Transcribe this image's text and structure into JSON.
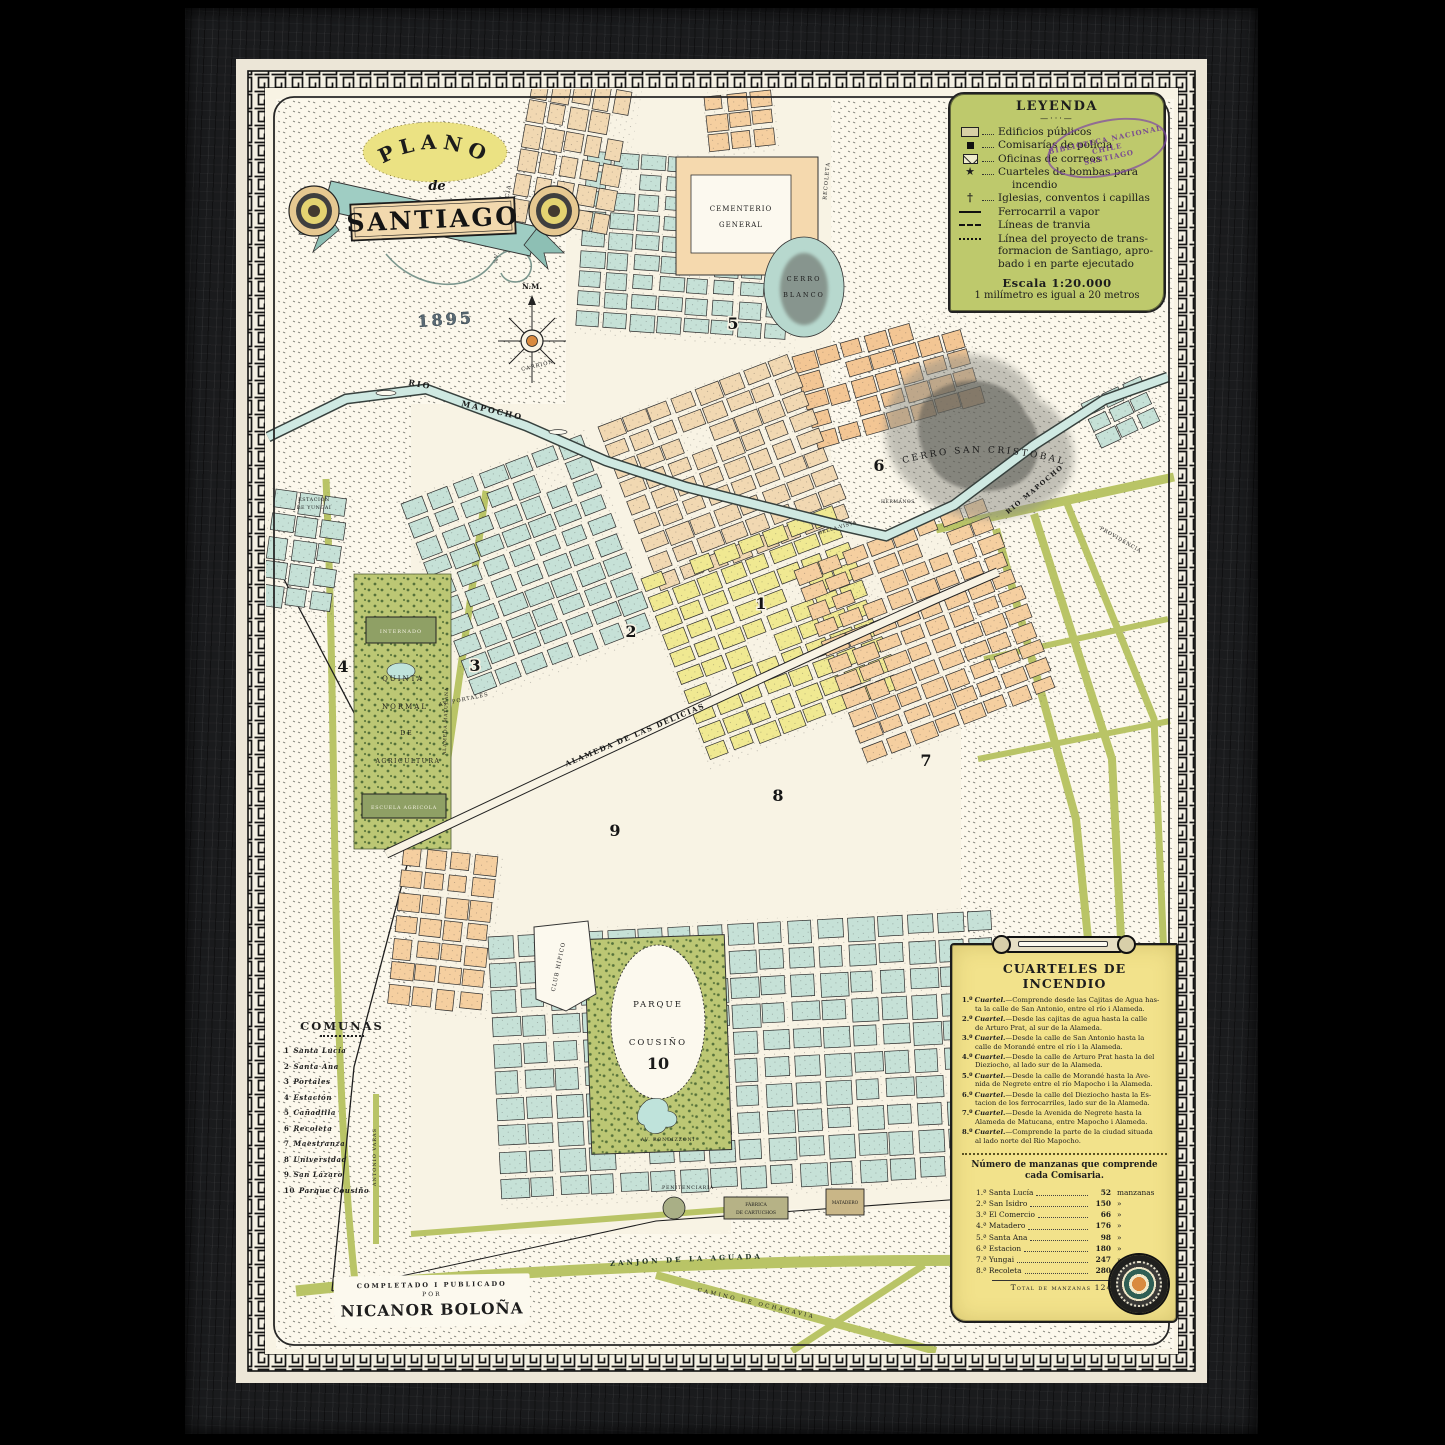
{
  "artwork": {
    "kind": "Framed antique city map",
    "cartouche": {
      "plano": "PLANO",
      "de": "de",
      "santiago": "SANTIAGO",
      "year": "1895"
    },
    "compass": {
      "label": "N.M."
    },
    "credit": {
      "line1": "COMPLETADO I PUBLICADO",
      "line2": "POR",
      "line3": "NICANOR BOLOÑA"
    }
  },
  "legend": {
    "title": "LEYENDA",
    "divider": "—···—",
    "items": [
      {
        "symbol": "public-building",
        "lines": [
          "Edificios públicos"
        ]
      },
      {
        "symbol": "police-station",
        "lines": [
          "Comisarías de policía"
        ]
      },
      {
        "symbol": "post-office",
        "lines": [
          "Oficinas de correos"
        ]
      },
      {
        "symbol": "fire-station",
        "lines": [
          "Cuarteles de bombas para",
          "incendio"
        ]
      },
      {
        "symbol": "church",
        "lines": [
          "Iglesias, conventos i capillas"
        ]
      },
      {
        "symbol": "steam-railway",
        "lines": [
          "Ferrocarril a vapor"
        ]
      },
      {
        "symbol": "tram-line",
        "lines": [
          "Líneas de tranvia"
        ]
      },
      {
        "symbol": "project-line",
        "lines": [
          "Línea del proyecto de trans-",
          "formacion de Santiago, apro-",
          "bado i en parte ejecutado"
        ]
      }
    ],
    "scale1": "Escala 1:20.000",
    "scale2": "1 milímetro es igual a 20 metros",
    "stamp": {
      "line1": "BIBLIOTECA NACIONAL",
      "line2": "CHILE",
      "line3": "SANTIAGO"
    }
  },
  "comunas": {
    "title": "COMUNAS",
    "items": [
      {
        "num": "1",
        "name": "Santa Lucía"
      },
      {
        "num": "2",
        "name": "Santa Ana"
      },
      {
        "num": "3",
        "name": "Portales"
      },
      {
        "num": "4",
        "name": "Estación"
      },
      {
        "num": "5",
        "name": "Cañadilla"
      },
      {
        "num": "6",
        "name": "Recoleta"
      },
      {
        "num": "7",
        "name": "Maestranza"
      },
      {
        "num": "8",
        "name": "Universidad"
      },
      {
        "num": "9",
        "name": "San Lázaro"
      },
      {
        "num": "10",
        "name": "Parque Cousiño"
      }
    ]
  },
  "cuarteles": {
    "title": "CUARTELES DE INCENDIO",
    "word": "Cuartel.",
    "items": [
      {
        "n": "1.º",
        "t0": "—Comprende desde las Cajitas de Agua has-",
        "t1": "ta la calle de San Antonio, entre el río i Alameda."
      },
      {
        "n": "2.º",
        "t0": "—Desde las cajitas de agua hasta la calle",
        "t1": "de Arturo Prat, al sur de la Alameda."
      },
      {
        "n": "3.º",
        "t0": "—Desde la calle de San Antonio hasta la",
        "t1": "calle de Morandé entre el río i la Alameda."
      },
      {
        "n": "4.º",
        "t0": "—Desde la calle de Arturo Prat hasta la del",
        "t1": "Dieziocho, al lado sur de la Alameda."
      },
      {
        "n": "5.º",
        "t0": "—Desde la calle de Morandé hasta la Ave-",
        "t1": "nida de Negrete entre el río Mapocho i la Alameda."
      },
      {
        "n": "6.º",
        "t0": "—Desde la calle del Dieziocho hasta la Es-",
        "t1": "tacion de los ferrocarriles, lado sur de la Alameda."
      },
      {
        "n": "7.º",
        "t0": "—Desde la Avenida de Negrete hasta la",
        "t1": "Alameda de Matucana, entre Mapocho i Alameda."
      },
      {
        "n": "8.º",
        "t0": "—Comprende la parte de la ciudad situada",
        "t1": "al lado norte del Rio Mapocho."
      }
    ],
    "manzanas_title1": "Número de manzanas que comprende",
    "manzanas_title2": "cada Comisaria.",
    "rows": [
      {
        "name": "1.ª Santa Lucía",
        "value": "52",
        "unit": "manzanas"
      },
      {
        "name": "2.ª San Isidro",
        "value": "150",
        "unit": "»"
      },
      {
        "name": "3.ª El Comercio",
        "value": "66",
        "unit": "»"
      },
      {
        "name": "4.ª Matadero",
        "value": "176",
        "unit": "»"
      },
      {
        "name": "5.ª Santa Ana",
        "value": "98",
        "unit": "»"
      },
      {
        "name": "6.ª Estacion",
        "value": "180",
        "unit": "»"
      },
      {
        "name": "7.ª Yungai",
        "value": "247",
        "unit": "»"
      },
      {
        "name": "8.ª Recoleta",
        "value": "280",
        "unit": "»"
      }
    ],
    "total": "Total de manzanas 1249"
  },
  "map_labels": {
    "rio_w1": "RIO",
    "rio_w2": "MAPOCHO",
    "rio_e": "RIO MAPOCHO",
    "cerro_sc": "CERRO SAN CRISTOBAL",
    "cerro_b1": "CERRO",
    "cerro_b2": "BLANCO",
    "cem1": "CEMENTERIO",
    "cem2": "GENERAL",
    "alameda": "ALAMEDA DE LAS DELICIAS",
    "parque1": "PARQUE",
    "parque2": "COUSIÑO",
    "parque_num": "10",
    "club": "CLUB HÍPICO",
    "q1": "QUINTA",
    "q2": "NORMAL",
    "q3": "DE",
    "q4": "AGRICULTURA",
    "internado": "INTERNADO",
    "escuela": "ESCUELA AGRICOLA",
    "portales": "AV. PORTALES",
    "independencia": "AV. INDEPENDENCIA",
    "carrion": "CARRIÓN",
    "recoleta": "RECOLETA",
    "bellavista": "BELLA-VISTA",
    "hermanos": "HERMANOS",
    "providencia": "PROVIDENCIA",
    "varas": "ANTONIO VARAS",
    "matucana": "ALAMEDA MATUCANA",
    "zanjon": "ZANJON  DE  LA  AGUADA",
    "ochagavia": "CAMINO  DE  OCHAGAVIA",
    "rondizzoni": "AV. RONDIZZONI",
    "penitenciaria": "PENITENCIARIA",
    "fabrica1": "FÁBRICA",
    "fabrica2": "DE CARTUCHOS",
    "matadero": "MATADERO",
    "yungai1": "ESTACION",
    "yungai2": "DE YUNGAI"
  },
  "districts": [
    "1",
    "2",
    "3",
    "4",
    "5",
    "6",
    "7",
    "8",
    "9",
    "10"
  ],
  "colors": {
    "frame_wood": "#1a1b1d",
    "mat": "#ece6d7",
    "paper": "#f8f3e4",
    "field": "#fcf8ec",
    "legend_green": "#bec96c",
    "panel_yellow": "#f2e28b",
    "block_teal": "#c6e1d7",
    "block_tan": "#f1d8b2",
    "block_peach": "#f5cfa0",
    "block_yellow": "#f0e992",
    "road_olive": "#b9c466",
    "river": "#cfe9e2",
    "stamp_purple": "#7d46a5"
  }
}
